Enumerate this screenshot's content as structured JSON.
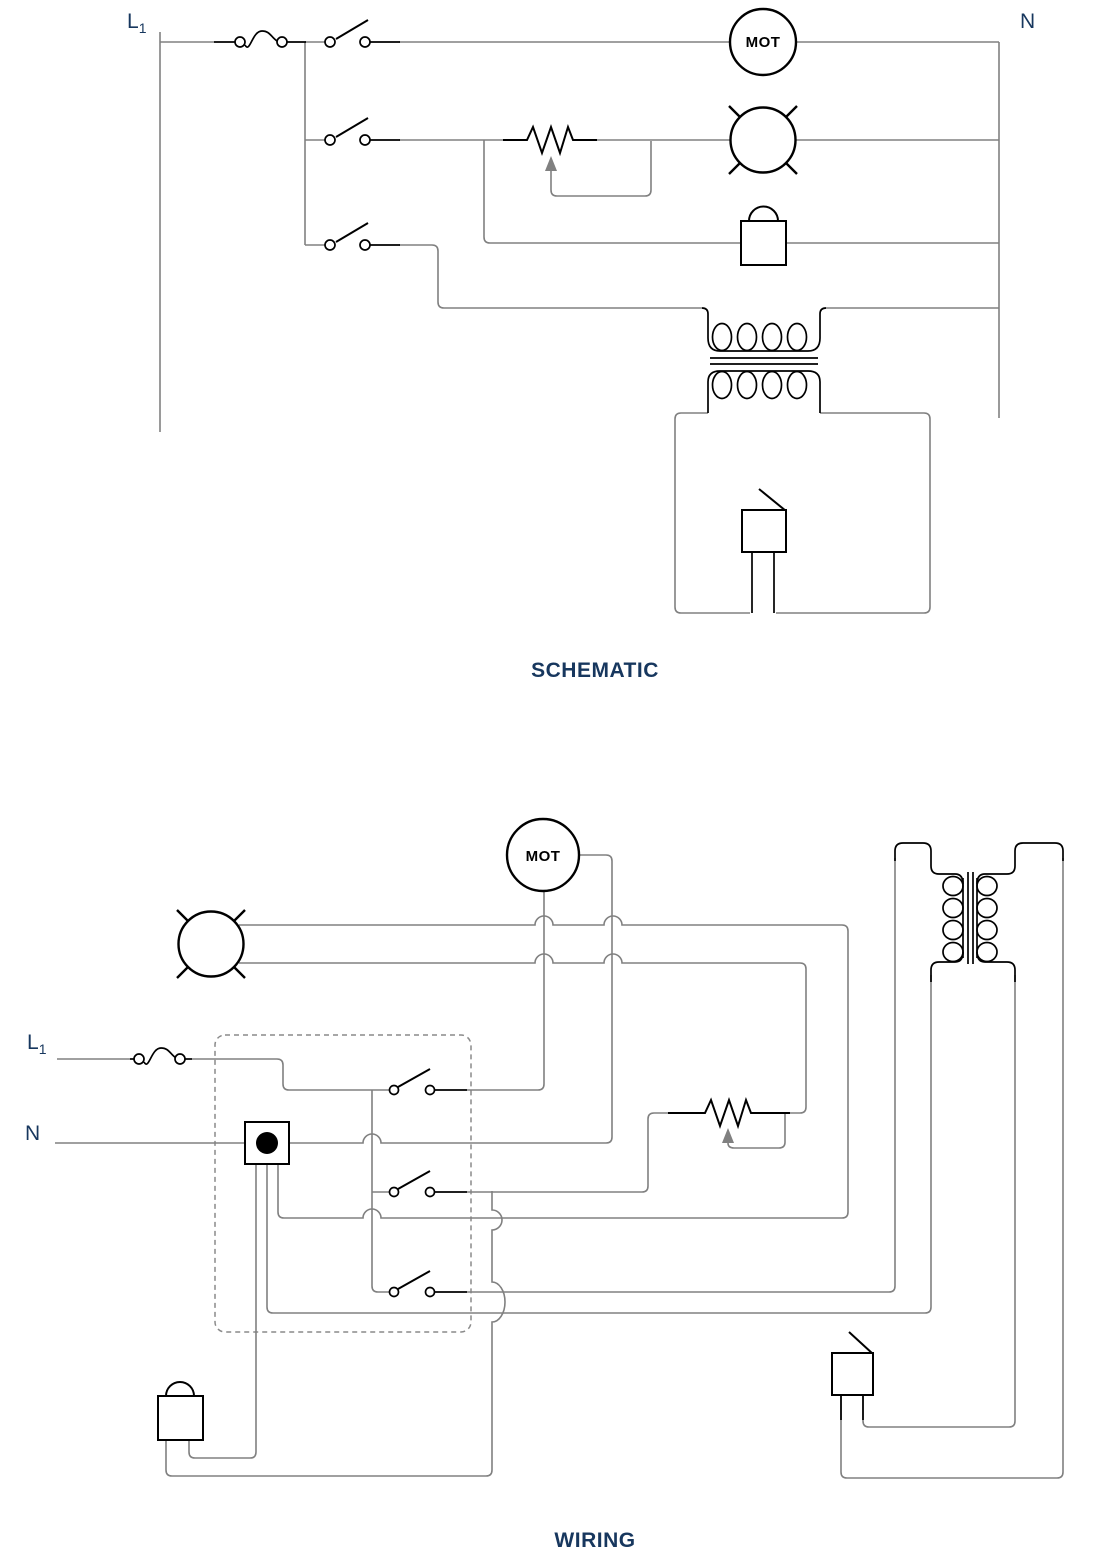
{
  "figure": {
    "background": "#ffffff",
    "colors": {
      "wire": "#808080",
      "symbol": "#000000",
      "label": "#17375E"
    }
  },
  "schematic": {
    "title": "SCHEMATIC",
    "line_label": {
      "base": "L",
      "sub": "1"
    },
    "neutral_label": "N",
    "motor_label": "MOT"
  },
  "wiring": {
    "title": "WIRING",
    "line_label": {
      "base": "L",
      "sub": "1"
    },
    "neutral_label": "N",
    "motor_label": "MOT"
  }
}
